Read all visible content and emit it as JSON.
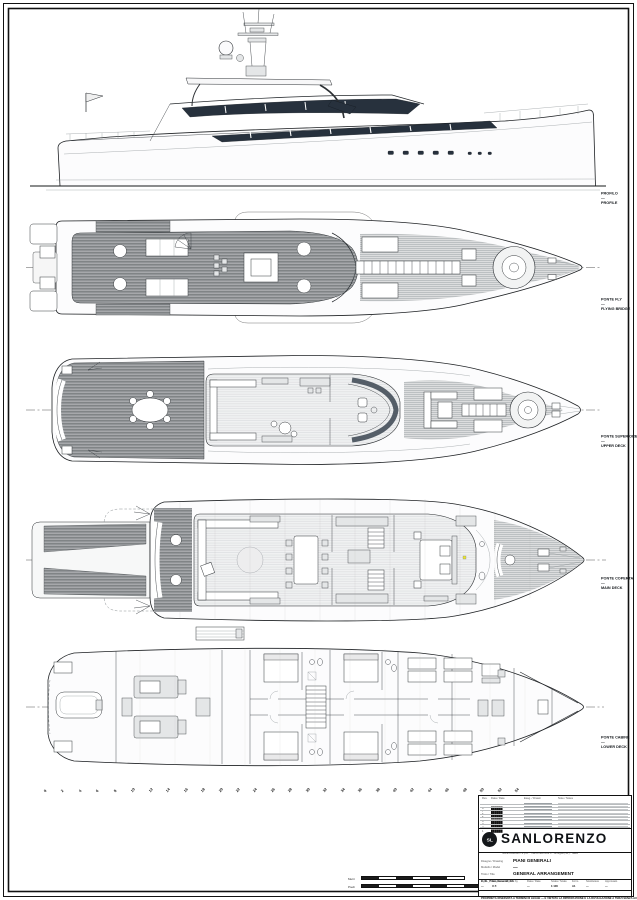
{
  "page": {
    "background": "#ffffff",
    "frame_color": "#111111",
    "drawing_kind": "yacht general arrangement sheet"
  },
  "views": [
    {
      "id": "profile",
      "label_it": "PROFILO",
      "separator": "—",
      "label_en": "PROFILE"
    },
    {
      "id": "flying-bridge",
      "label_it": "PONTE FLY",
      "separator": "—",
      "label_en": "FLYING BRIDGE"
    },
    {
      "id": "upper-deck",
      "label_it": "PONTE SUPERIORE",
      "separator": "—",
      "label_en": "UPPER DECK"
    },
    {
      "id": "main-deck",
      "label_it": "PONTE COPERTA",
      "separator": "—",
      "label_en": "MAIN DECK"
    },
    {
      "id": "lower-deck",
      "label_it": "PONTE CABINE",
      "separator": "—",
      "label_en": "LOWER DECK"
    }
  ],
  "frame_marks": [
    "0",
    "2",
    "4",
    "6",
    "8",
    "10",
    "12",
    "14",
    "16",
    "18",
    "20",
    "22",
    "24",
    "26",
    "28",
    "30",
    "32",
    "34",
    "36",
    "38",
    "40",
    "42",
    "44",
    "46",
    "48",
    "50",
    "52",
    "54"
  ],
  "scale_bars": [
    {
      "label": "Metri",
      "segments": 6
    },
    {
      "label": "Piedi",
      "segments": 7
    }
  ],
  "title_block": {
    "revision_header": {
      "rev": "Rev.",
      "date": "Data / Date",
      "drawn": "Eseg. / Drawn",
      "note": "Note / Notes"
    },
    "revisions": [
      {
        "rev": "8",
        "date": "██████"
      },
      {
        "rev": "7",
        "date": "██████"
      },
      {
        "rev": "6",
        "date": "██████"
      },
      {
        "rev": "5",
        "date": "██████"
      },
      {
        "rev": "4",
        "date": "██████"
      },
      {
        "rev": "3",
        "date": "██████"
      },
      {
        "rev": "2",
        "date": "██████"
      },
      {
        "rev": "1",
        "date": "██████"
      }
    ],
    "brand": "SANLORENZO",
    "logo_monogram": "SL",
    "brand_subline": "SANLORENZO S.p.A. · Via Armezzone 3 · Ameglia (SP) · Italia",
    "fields": [
      {
        "label": "Disegno / Drawing",
        "value": "PIANI GENERALI"
      },
      {
        "label": "Modello / Model",
        "value": "—"
      },
      {
        "label": "Titolo / Title",
        "value": "GENERAL ARRANGEMENT"
      }
    ],
    "file_name": "C_SL_Piani_Generali_GA",
    "info_columns": [
      {
        "label": "Rev.",
        "value": "—"
      },
      {
        "label": "Esecutore / Drawn by",
        "value": "U.T."
      },
      {
        "label": "Data / Date",
        "value": "—"
      },
      {
        "label": "Scala / Scale",
        "value": "1:100"
      },
      {
        "label": "Form.",
        "value": "A1"
      },
      {
        "label": "Sostituisce",
        "value": "—"
      },
      {
        "label": "Approvato",
        "value": "—"
      }
    ],
    "disclaimer": "PROPRIETÀ RISERVATA A TERMINI DI LEGGE — È VIETATA LA RIPRODUZIONE E LA DIVULGAZIONE A TERZI SENZA AUTORIZZAZIONE SCRITTA."
  }
}
